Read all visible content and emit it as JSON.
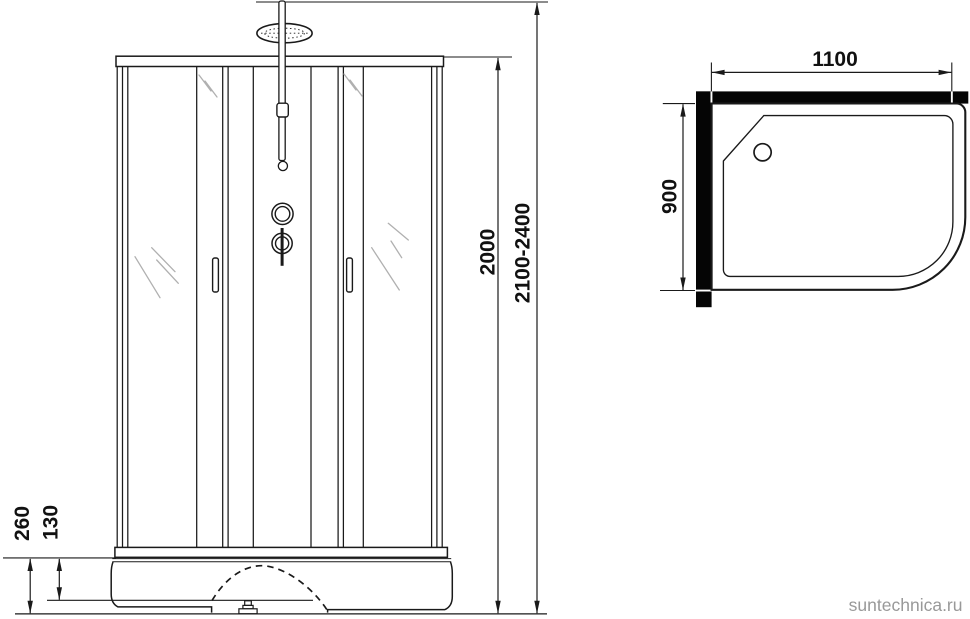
{
  "diagram_title": "shower-cabin-dimension-drawing",
  "colors": {
    "background": "#ffffff",
    "line": "#1a1a1a",
    "wall_fill": "#000000",
    "glass_shine": "#b0b0b0",
    "watermark": "#999999"
  },
  "front_view": {
    "name": "shower cabin front elevation",
    "dims": {
      "cabin_height": "2000",
      "total_height_range": "2100-2400",
      "tray_height": "260",
      "tray_step_height": "130"
    }
  },
  "top_view": {
    "name": "shower tray plan view",
    "dims": {
      "width": "1100",
      "depth": "900"
    }
  },
  "watermark": {
    "text": "suntechnica.ru"
  }
}
